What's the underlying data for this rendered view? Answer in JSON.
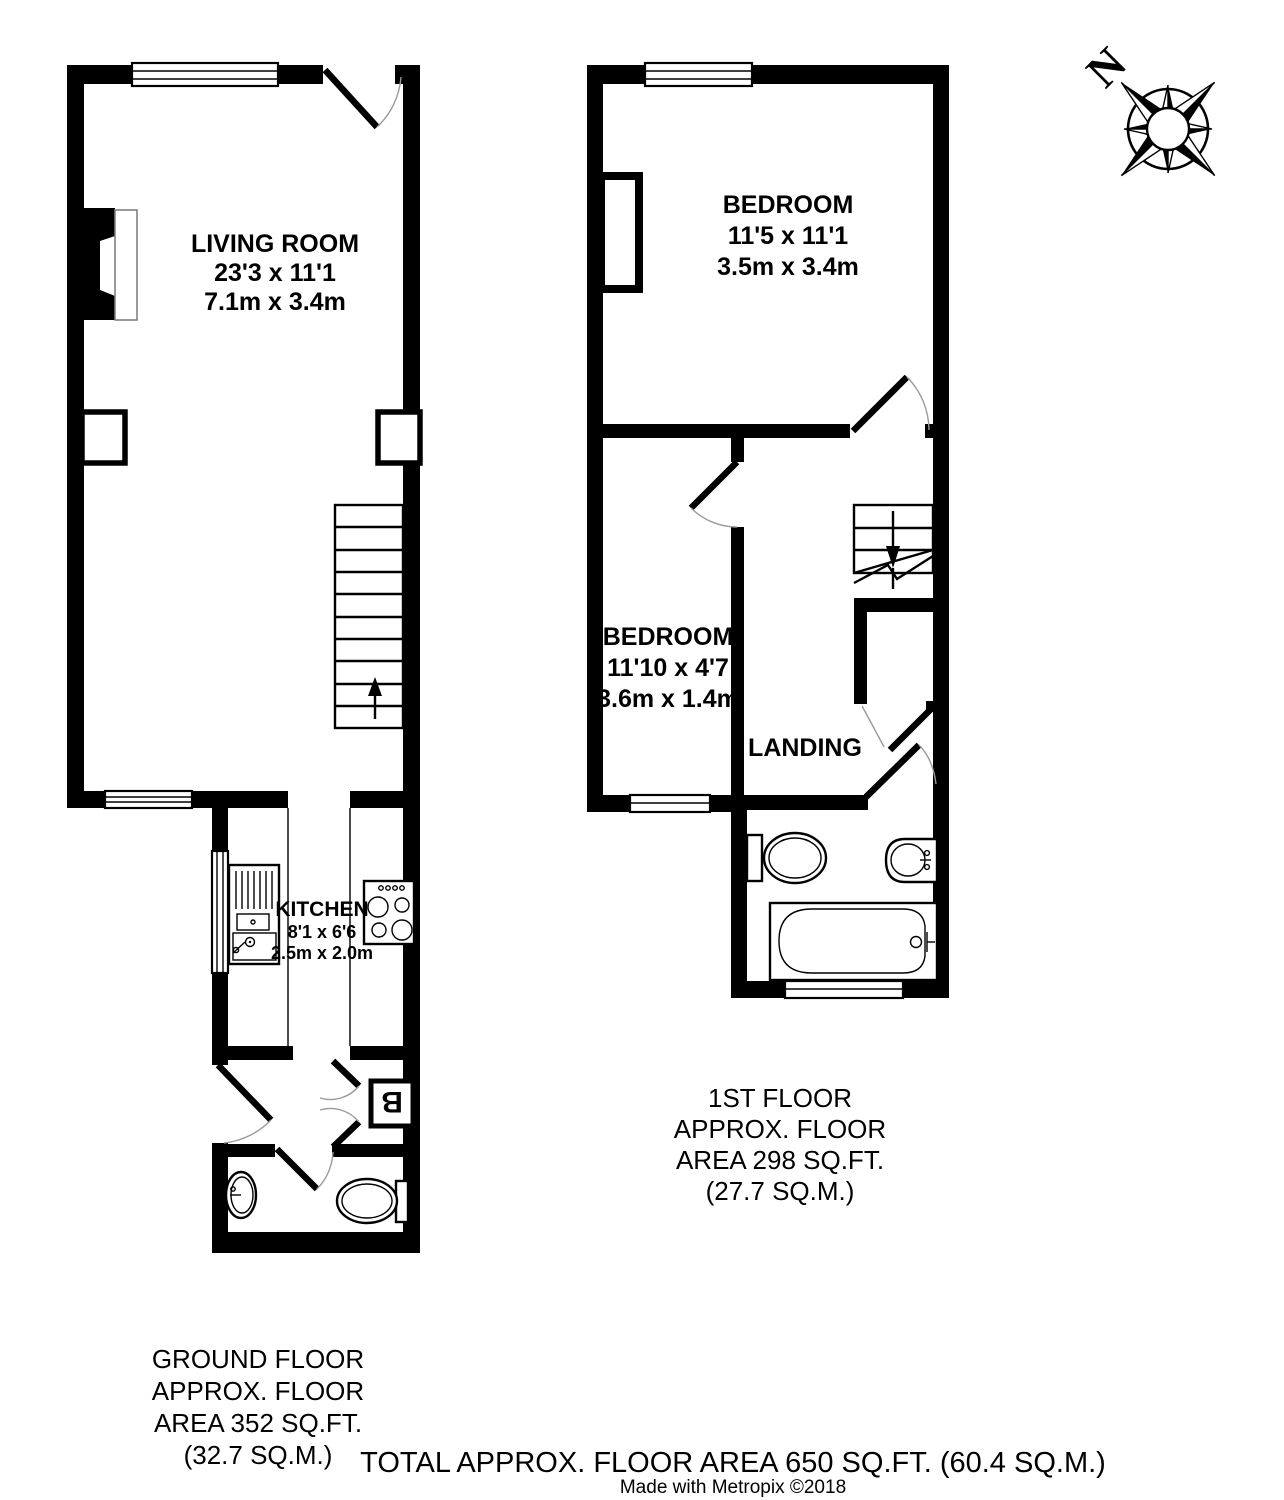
{
  "document": {
    "type": "property-floor-plan",
    "colors": {
      "wall": "#000000",
      "background": "#ffffff",
      "fireplace_outline": "#808080"
    }
  },
  "compass": {
    "north_label": "N"
  },
  "ground_floor": {
    "rooms": {
      "living_room": {
        "name": "LIVING ROOM",
        "dims_imperial": "23'3 x 11'1",
        "dims_metric": "7.1m x 3.4m"
      },
      "kitchen": {
        "name": "KITCHEN",
        "dims_imperial": "8'1 x 6'6",
        "dims_metric": "2.5m x 2.0m"
      },
      "boiler_label": "B"
    },
    "caption": {
      "line1": "GROUND FLOOR",
      "line2": "APPROX. FLOOR",
      "line3": "AREA 352 SQ.FT.",
      "line4": "(32.7 SQ.M.)"
    }
  },
  "first_floor": {
    "rooms": {
      "bedroom_front": {
        "name": "BEDROOM",
        "dims_imperial": "11'5 x 11'1",
        "dims_metric": "3.5m x 3.4m"
      },
      "bedroom_small": {
        "name": "BEDROOM",
        "dims_imperial": "11'10 x 4'7",
        "dims_metric": "3.6m x 1.4m"
      },
      "landing": {
        "name": "LANDING"
      }
    },
    "caption": {
      "line1": "1ST FLOOR",
      "line2": "APPROX. FLOOR",
      "line3": "AREA 298 SQ.FT.",
      "line4": "(27.7 SQ.M.)"
    }
  },
  "footer": {
    "total": "TOTAL APPROX. FLOOR AREA 650 SQ.FT. (60.4 SQ.M.)",
    "credit": "Made with Metropix ©2018"
  }
}
